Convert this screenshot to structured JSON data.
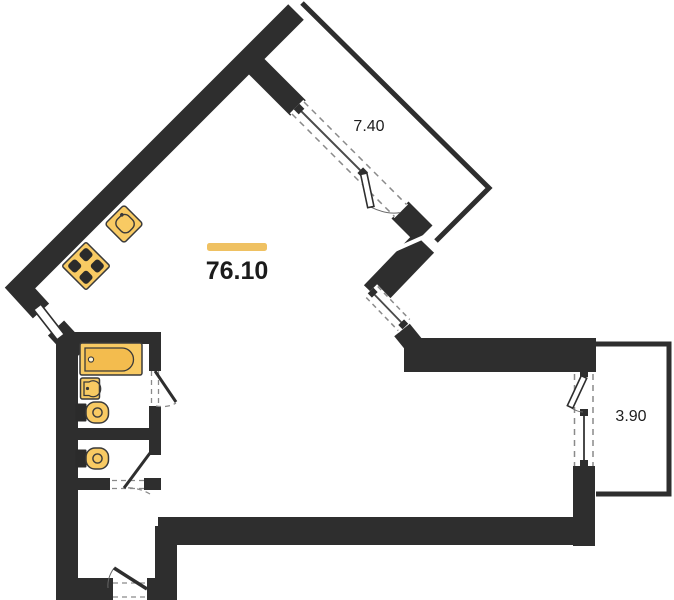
{
  "plan": {
    "type": "apartment-floor-plan",
    "background": "#ffffff",
    "wall_color": "#2e2e2e",
    "fixture_color": "#f8ca63",
    "fixture_inner_color": "#f3bc4e",
    "accent_bar_color": "#efc162",
    "text_color": "#1b1b1b",
    "dash_color": "#8a8a8a",
    "labels": {
      "living_area": "76.10",
      "balcony_top": "7.40",
      "balcony_right": "3.90"
    },
    "fixtures": [
      "kitchen-sink",
      "stove",
      "bathtub",
      "washbasin",
      "toilet",
      "toilet"
    ],
    "doors": [
      "entrance-door",
      "bathroom-door",
      "wc-door",
      "side-door",
      "balcony-door-top",
      "balcony-door-right"
    ],
    "windows": [
      "window-top-balcony",
      "window-corner",
      "window-right-balcony"
    ]
  }
}
